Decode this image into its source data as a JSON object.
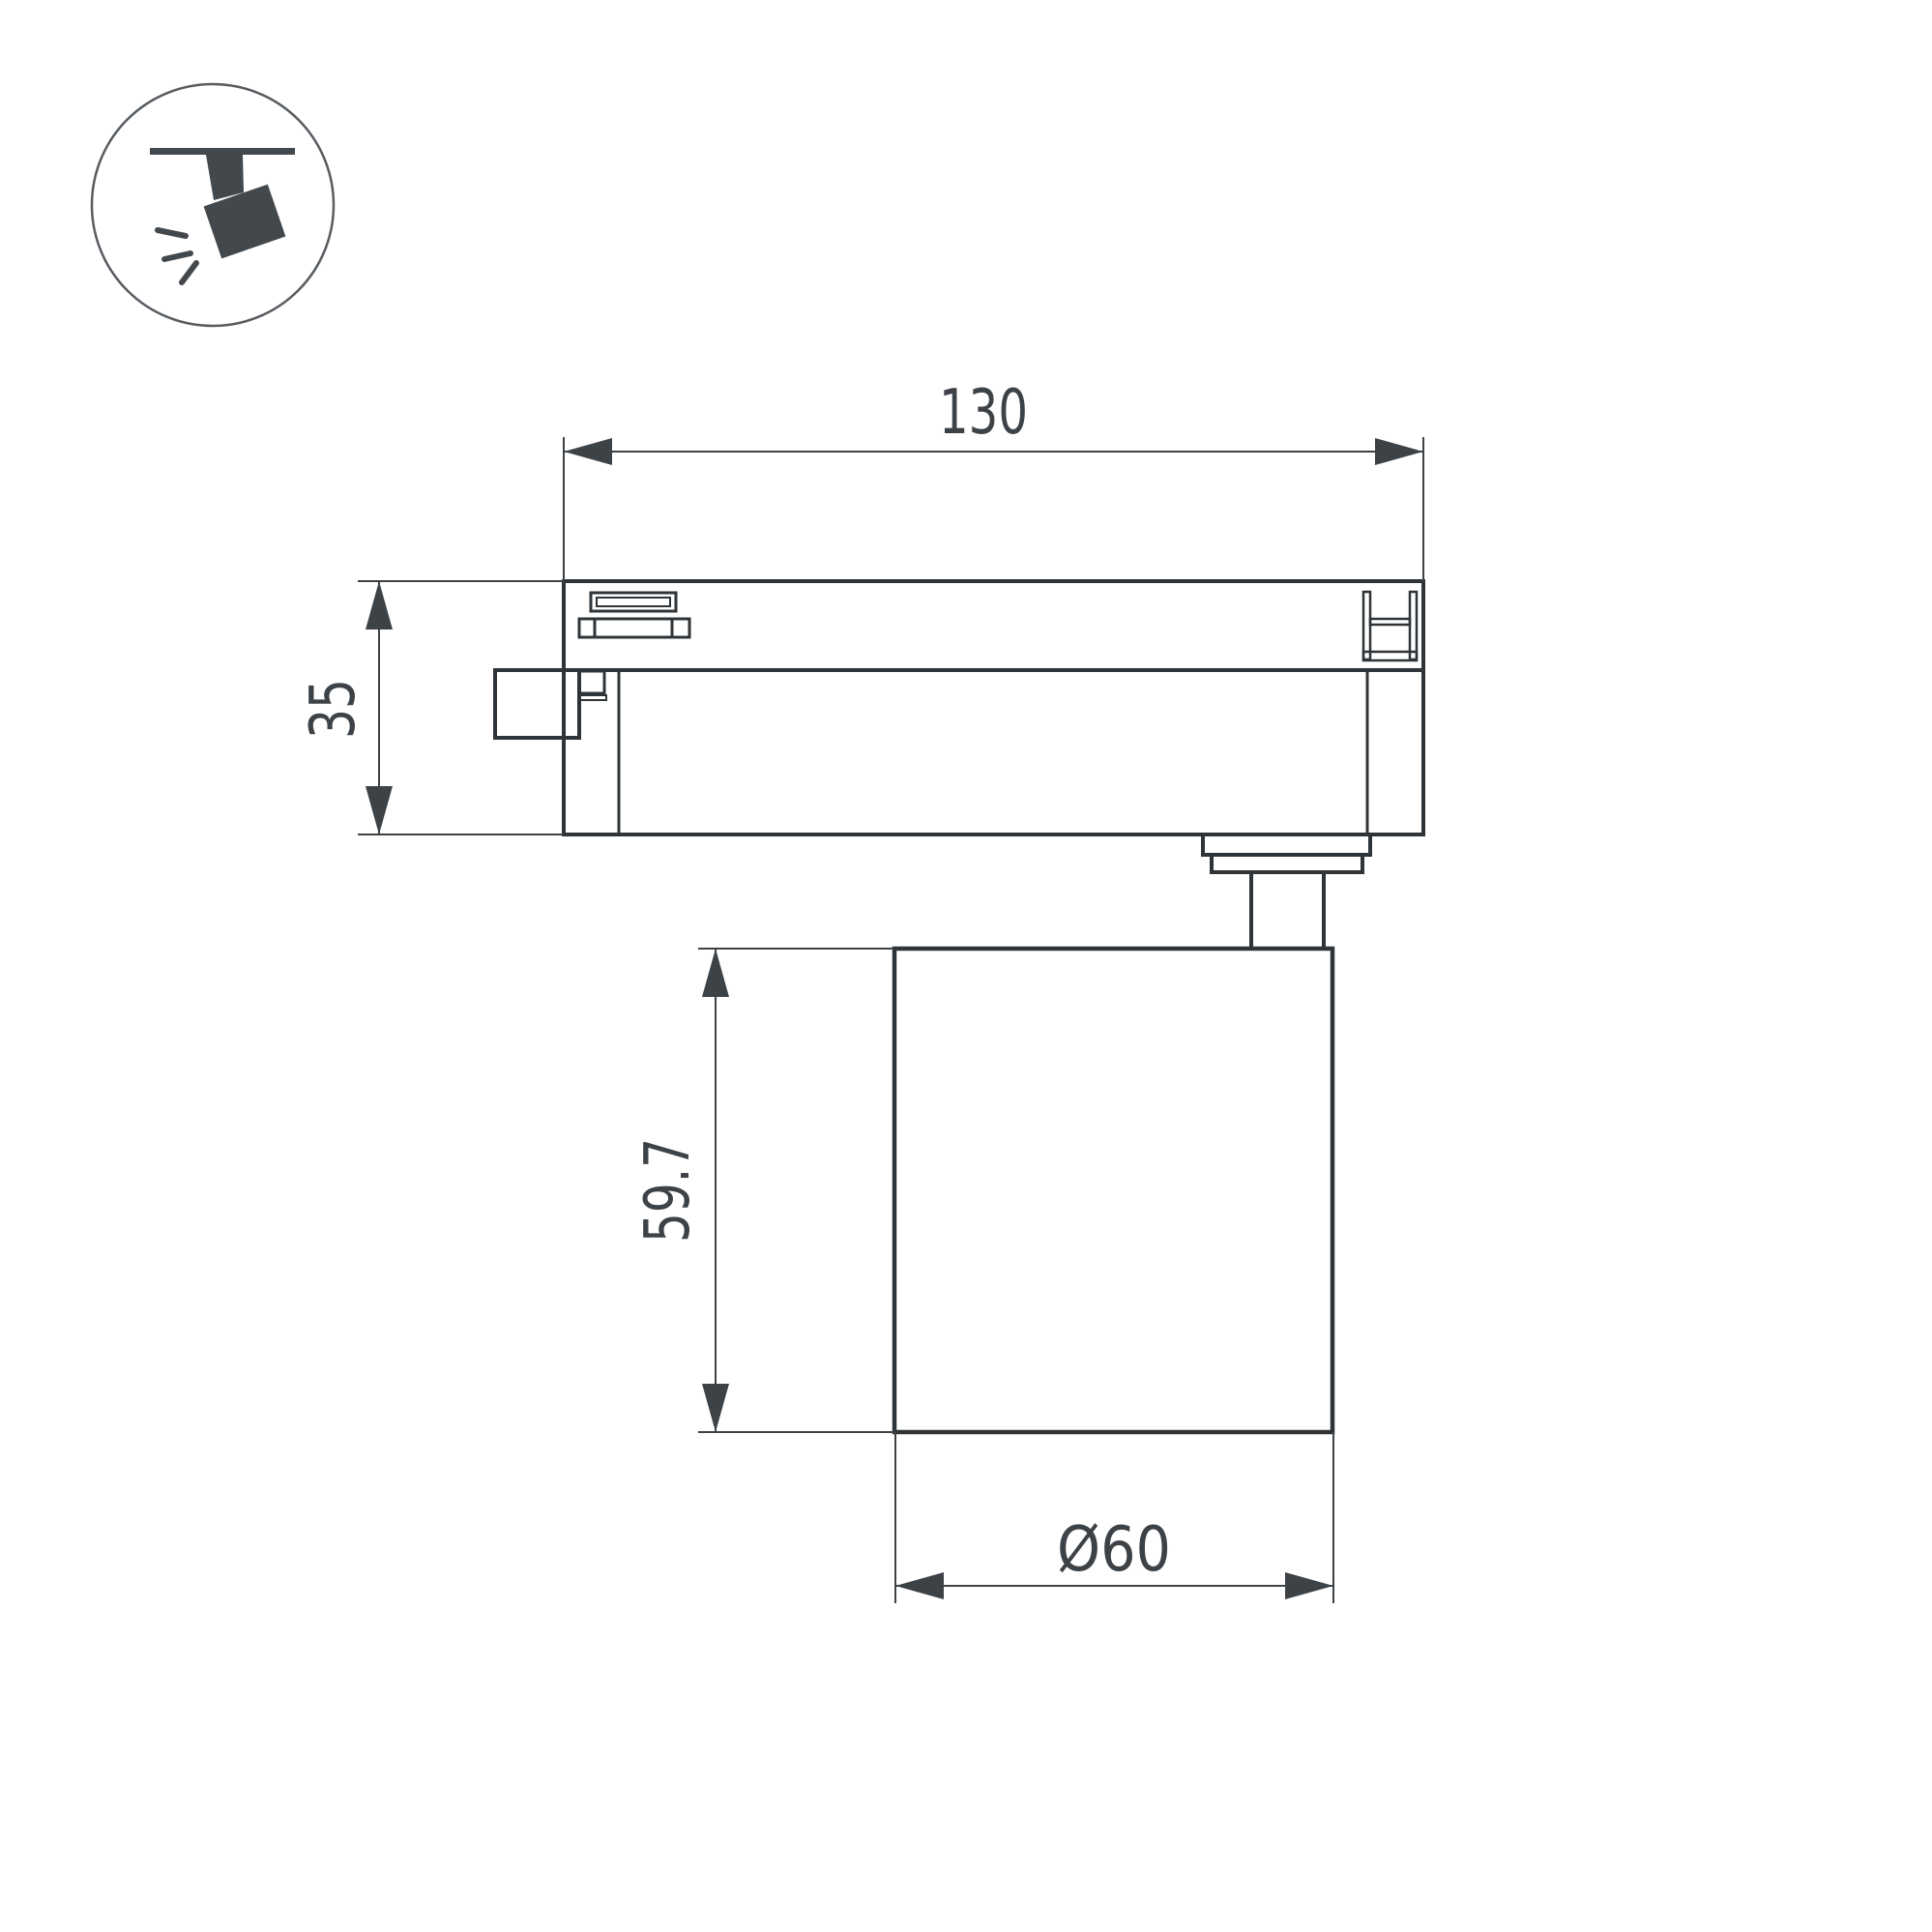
{
  "drawing": {
    "title": "track-spotlight-dimension-drawing",
    "background": "#ffffff",
    "colors": {
      "line": "#2f3438",
      "text": "#3d4247",
      "icon_fill": "#43484d",
      "icon_circle_stroke": "#575c61"
    },
    "icon": {
      "name": "ceiling-track-spotlight-pictogram"
    },
    "dimensions": {
      "width_total": {
        "value": "130"
      },
      "adapter_height": {
        "value": "35"
      },
      "body_height": {
        "value": "59.7"
      },
      "body_diameter": {
        "value": "Ø60"
      }
    }
  }
}
